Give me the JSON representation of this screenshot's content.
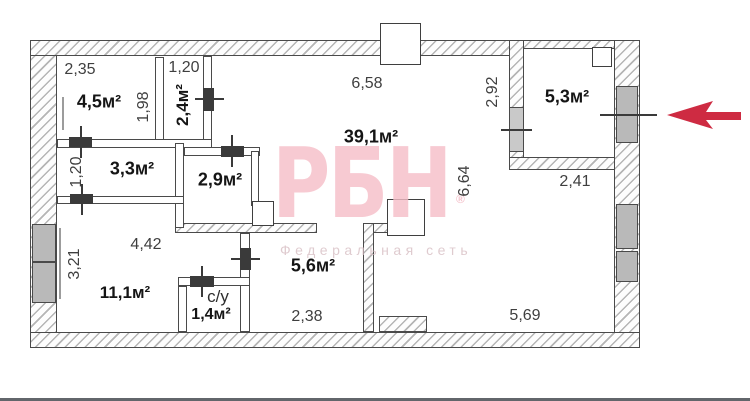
{
  "plan": {
    "rooms": {
      "r45": "4,5м²",
      "r24": "2,4м²",
      "r33": "3,3м²",
      "r29": "2,9м²",
      "r391": "39,1м²",
      "r53": "5,3м²",
      "r111": "11,1м²",
      "r56": "5,6м²",
      "r14": "1,4м²",
      "bath": "с/у"
    },
    "dims": {
      "d235": "2,35",
      "d120a": "1,20",
      "d198": "1,98",
      "d658": "6,58",
      "d292": "2,92",
      "d241": "2,41",
      "d120b": "1,20",
      "d442": "4,42",
      "d321": "3,21",
      "d664": "6,64",
      "d238": "2,38",
      "d569": "5,69"
    }
  },
  "watermark": {
    "logo": "РБН",
    "reg": "®",
    "subtitle": "Федеральная сеть"
  },
  "colors": {
    "arrow": "#ce2b42",
    "watermark_logo": "#f6bec8",
    "watermark_text": "#d8bfc4"
  }
}
